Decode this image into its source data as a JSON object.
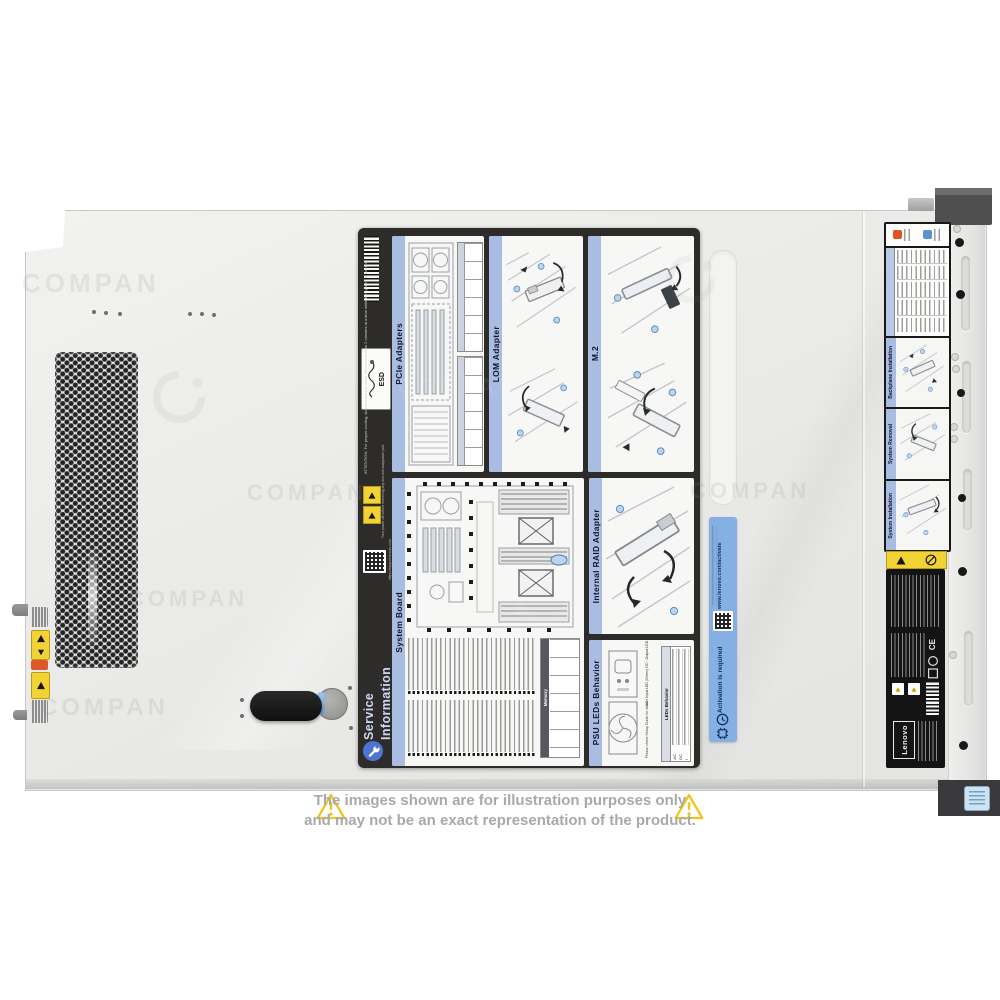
{
  "image_type": "server-top-view-product-photo",
  "colors": {
    "chassis": "#ececea",
    "service_label_bg": "#2d2c2a",
    "panel_title_bar": "#a9bce2",
    "activation_bg": "#85b0e4",
    "warning_yellow": "#f2d335",
    "alert_orange": "#dd5a28",
    "led_blue": "#5b8fd6",
    "power_button_blue": "#cde3f4"
  },
  "watermark": {
    "text": "COMPAN"
  },
  "service_label": {
    "esd": "ESD",
    "attention": "ATTENTION: For proper cooling, do not leave top cover off for more than 2 minutes at a time while the system is running.",
    "power_warning": "Turn power off before removing any non-hot-swappable part.",
    "support_url": "https://support.lenovo.com",
    "service_info": {
      "line1": "Service",
      "line2": "Information"
    },
    "panels": {
      "pcie": "PCIe Adapters",
      "lom": "LOM Adapter",
      "m2": "M.2",
      "system_board": "System Board",
      "raid": "Internal RAID Adapter",
      "psu": "PSU LEDs Behavior"
    },
    "system_board_panel": {
      "memory_header": "Memory"
    },
    "psu_panel": {
      "legend": [
        "AC : Input LED (Green)",
        "DC : Output LED (Green)",
        "!  : Error LED (Yellow)"
      ],
      "note": "Please check Setup Guide for details.",
      "table_header": "LEDs Behavior",
      "rows": [
        "AC",
        "DC",
        "!"
      ]
    }
  },
  "activation_label": {
    "url": "www.lenovo.com/activate",
    "title": "Activation is required"
  },
  "front_labels": {
    "panels": [
      "Backplane Installation",
      "System Removal",
      "System Installation"
    ]
  },
  "regulatory_label": {
    "ce": "CE",
    "brand": "Lenovo"
  },
  "disclaimer": {
    "line1": "The images shown are for illustration purposes only",
    "line2": "and may not be an exact representation of the product."
  }
}
